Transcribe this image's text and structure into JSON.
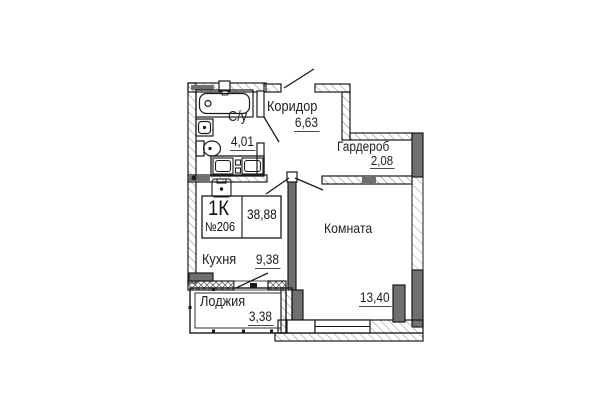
{
  "apartment": {
    "type_label": "1К",
    "number": "№206",
    "total_area": "38,88"
  },
  "rooms": [
    {
      "id": "koridor",
      "name": "Коридор",
      "area": "6,63"
    },
    {
      "id": "su",
      "name": "С/у",
      "area": "4,01"
    },
    {
      "id": "garderob",
      "name": "Гардероб",
      "area": "2,08"
    },
    {
      "id": "komnata",
      "name": "Комната",
      "area": "13,40"
    },
    {
      "id": "kuhnya",
      "name": "Кухня",
      "area": "9,38"
    },
    {
      "id": "lodzhiya",
      "name": "Лоджия",
      "area": "3,38"
    }
  ],
  "colors": {
    "line": "#1a1a1a",
    "wall_fill": "#6f6f6f",
    "hatch": "#8f8f8f",
    "underline": "#4a4a4a",
    "background": "#ffffff"
  }
}
